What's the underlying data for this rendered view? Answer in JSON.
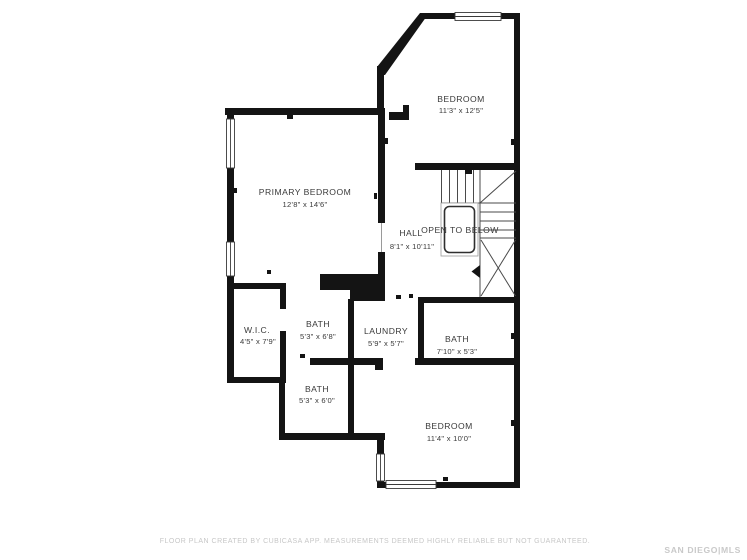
{
  "colors": {
    "wall": "#141414",
    "stair_line": "#4a4a4a",
    "label": "#3a3a3a",
    "muted": "#c7c7c7"
  },
  "rooms": {
    "bedroom_top": {
      "name": "BEDROOM",
      "dims": "11'3\" x 12'5\""
    },
    "primary_bedroom": {
      "name": "PRIMARY BEDROOM",
      "dims": "12'8\" x 14'6\""
    },
    "hall": {
      "name": "HALL",
      "dims": "8'1\" x 10'11\""
    },
    "open_to_below": {
      "label": "OPEN TO BELOW"
    },
    "wic": {
      "name": "W.I.C.",
      "dims": "4'5\" x 7'9\""
    },
    "bath_upper": {
      "name": "BATH",
      "dims": "5'3\" x 6'8\""
    },
    "laundry": {
      "name": "LAUNDRY",
      "dims": "5'9\" x 5'7\""
    },
    "bath_right": {
      "name": "BATH",
      "dims": "7'10\" x 5'3\""
    },
    "bath_lower": {
      "name": "BATH",
      "dims": "5'3\" x 6'0\""
    },
    "bedroom_bottom": {
      "name": "BEDROOM",
      "dims": "11'4\" x 10'0\""
    }
  },
  "footer": {
    "disclaimer": "FLOOR PLAN CREATED BY CUBICASA APP. MEASUREMENTS DEEMED HIGHLY RELIABLE BUT NOT GUARANTEED.",
    "watermark": "SAN DIEGO|MLS"
  }
}
